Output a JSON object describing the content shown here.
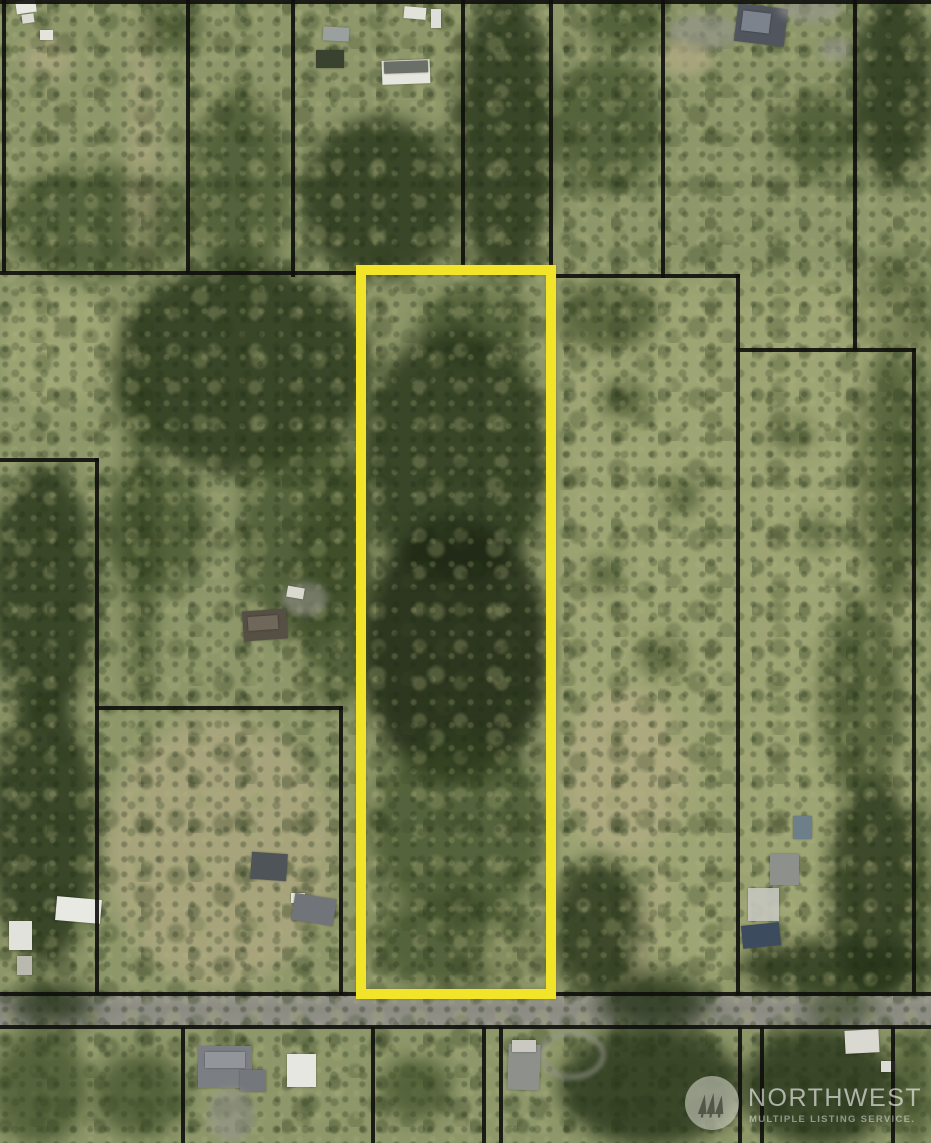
{
  "page": {
    "type": "aerial-parcel-map-photo",
    "description": "Aerial photograph of rural land parcels with black lot-boundary overlay; the subject lot is a tall narrow rectangle outlined in yellow, with an east-west road across the bottom of the frame."
  },
  "watermark": {
    "brand": "NORTHWEST",
    "tagline": "MULTIPLE LISTING SERVICE.",
    "logo_icon": "three-pine-trees-icon"
  },
  "map": {
    "highlighted_parcel": {
      "outline_color": "#f2e529",
      "shape": "tall-rectangle",
      "location": "center, extending from mid-frame down to the road"
    },
    "boundary_line_color": "#0e0e0c",
    "road": {
      "orientation": "horizontal",
      "position": "near-bottom",
      "color": "#8f9086"
    },
    "terrain_palette": {
      "grass": "#8d9769",
      "dark_trees": "#32421f",
      "dry_grass": "#adb07e",
      "dirt": "#b5ac86"
    }
  }
}
